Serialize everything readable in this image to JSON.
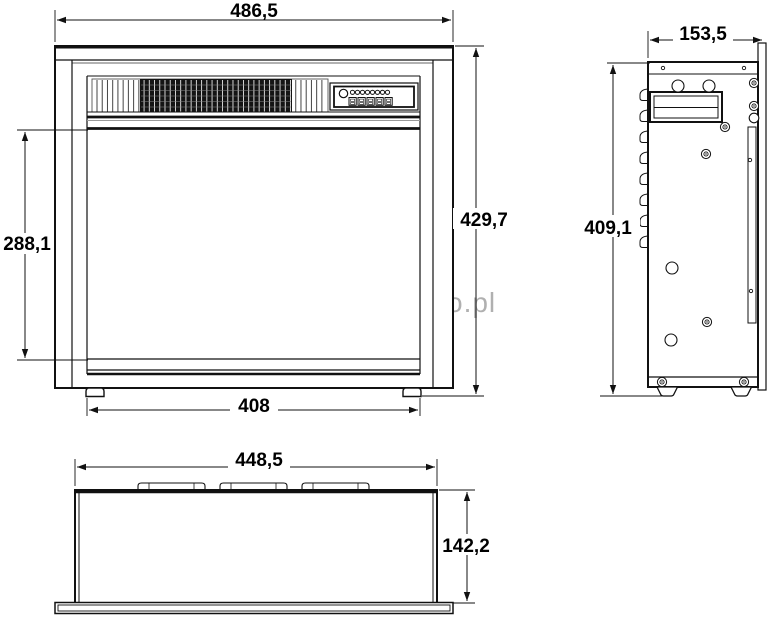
{
  "watermark": {
    "text": "www.komineo.pl",
    "color": "#b0b0b0"
  },
  "colors": {
    "line": "#111111",
    "background": "#ffffff"
  },
  "views": {
    "front": {
      "dims": {
        "overall_width": "486,5",
        "overall_height": "429,7",
        "opening_height": "288,1",
        "base_width": "408"
      }
    },
    "side": {
      "dims": {
        "depth": "153,5",
        "height": "409,1"
      }
    },
    "bottom": {
      "dims": {
        "width": "448,5",
        "depth": "142,2"
      }
    }
  }
}
